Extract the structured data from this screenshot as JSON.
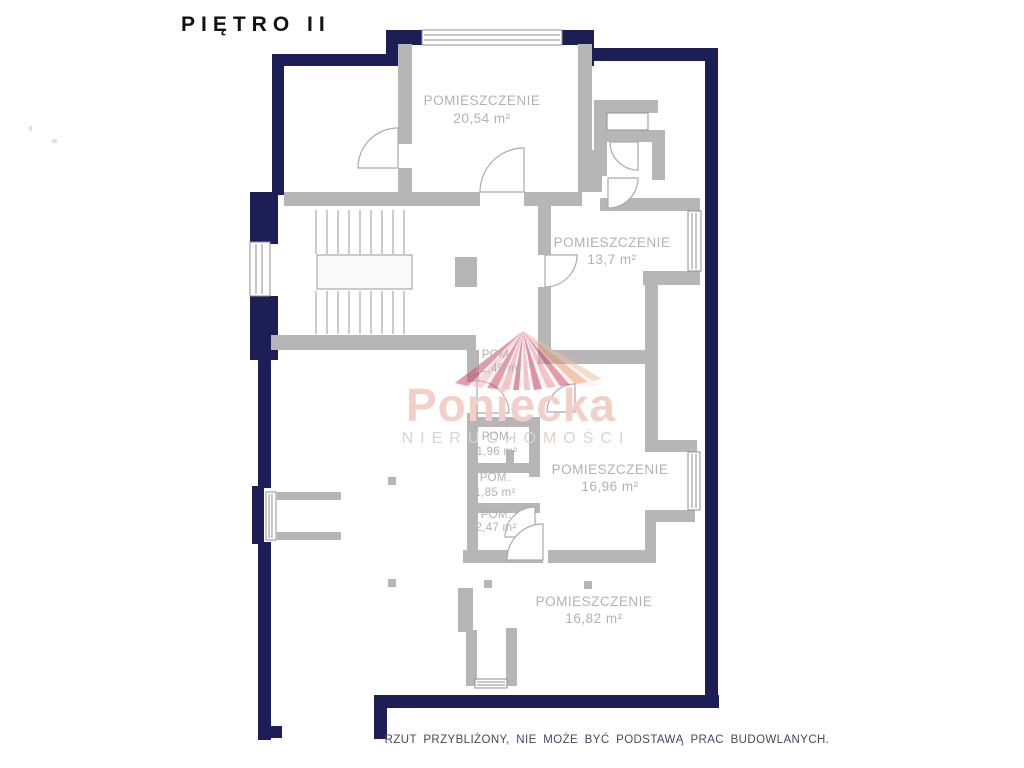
{
  "title": "PIĘTRO II",
  "plan": {
    "rooms": [
      {
        "id": "room-2054",
        "name": "POMIESZCZENIE",
        "area": "20,54 m²"
      },
      {
        "id": "room-137",
        "name": "POMIESZCZENIE",
        "area": "13,7 m²"
      },
      {
        "id": "room-1249",
        "name": "POM.",
        "area": "12,49 m²"
      },
      {
        "id": "room-196",
        "name": "POM.",
        "area": "1,96 m²"
      },
      {
        "id": "room-185",
        "name": "POM.",
        "area": "1,85 m²"
      },
      {
        "id": "room-247",
        "name": "POM.",
        "area": "2,47 m²"
      },
      {
        "id": "room-1696",
        "name": "POMIESZCZENIE",
        "area": "16,96 m²"
      },
      {
        "id": "room-1682",
        "name": "POMIESZCZENIE",
        "area": "16,82 m²"
      }
    ],
    "features": [
      "staircase",
      "balcony",
      "windows",
      "doors"
    ]
  },
  "watermark": {
    "brand": "Poniecka",
    "subtitle": "NIERUCHOMOŚCI"
  },
  "disclaimer": "RZUT PRZYBLIŻONY, NIE MOŻE BYĆ PODSTAWĄ PRAC BUDOWLANYCH.",
  "colors": {
    "outer_wall": "#1e1e56",
    "inner_wall": "#b6b6b6",
    "label": "#b2b2b2",
    "disclaimer": "#474760",
    "brand": "#f4cfc7",
    "brand_sub": "#ddd2d0",
    "door_stroke": "#ababab",
    "window_stroke": "#8f8f8f",
    "stair_stroke": "#9a9a9a",
    "watermark_ray_dark": "#c23a5e",
    "watermark_ray_light": "#f0b8c0",
    "watermark_ray_orange": "#e89a70"
  }
}
